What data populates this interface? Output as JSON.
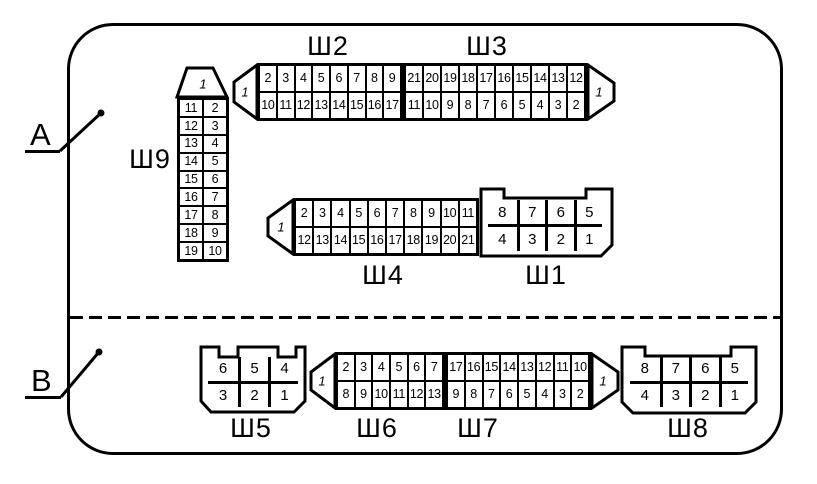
{
  "palette": {
    "ink": "#000000",
    "paper": "#ffffff"
  },
  "sections": {
    "a": {
      "label": "A"
    },
    "b": {
      "label": "B"
    }
  },
  "connectors": {
    "sh2": {
      "label": "Ш2",
      "end_pin": "1",
      "top": [
        "2",
        "3",
        "4",
        "5",
        "6",
        "7",
        "8",
        "9"
      ],
      "bottom": [
        "10",
        "11",
        "12",
        "13",
        "14",
        "15",
        "16",
        "17"
      ]
    },
    "sh3": {
      "label": "Ш3",
      "end_pin": "1",
      "top": [
        "21",
        "20",
        "19",
        "18",
        "17",
        "16",
        "15",
        "14",
        "13",
        "12"
      ],
      "bottom": [
        "11",
        "10",
        "9",
        "8",
        "7",
        "6",
        "5",
        "4",
        "3",
        "2"
      ]
    },
    "sh9": {
      "label": "Ш9",
      "end_pin": "1",
      "cells": [
        "11",
        "2",
        "12",
        "3",
        "13",
        "4",
        "14",
        "5",
        "15",
        "6",
        "16",
        "7",
        "17",
        "8",
        "18",
        "9",
        "19",
        "10"
      ]
    },
    "sh4": {
      "label": "Ш4",
      "end_pin": "1",
      "top": [
        "2",
        "3",
        "4",
        "5",
        "6",
        "7",
        "8",
        "9",
        "10",
        "11"
      ],
      "bottom": [
        "12",
        "13",
        "14",
        "15",
        "16",
        "17",
        "18",
        "19",
        "20",
        "21"
      ]
    },
    "sh1": {
      "label": "Ш1",
      "top": [
        "8",
        "7",
        "6",
        "5"
      ],
      "bottom": [
        "4",
        "3",
        "2",
        "1"
      ]
    },
    "sh5": {
      "label": "Ш5",
      "top": [
        "6",
        "5",
        "4"
      ],
      "bottom": [
        "3",
        "2",
        "1"
      ]
    },
    "sh6": {
      "label": "Ш6",
      "end_pin": "1",
      "top": [
        "2",
        "3",
        "4",
        "5",
        "6",
        "7"
      ],
      "bottom": [
        "8",
        "9",
        "10",
        "11",
        "12",
        "13"
      ]
    },
    "sh7": {
      "label": "Ш7",
      "end_pin": "1",
      "top": [
        "17",
        "16",
        "15",
        "14",
        "13",
        "12",
        "11",
        "10"
      ],
      "bottom": [
        "9",
        "8",
        "7",
        "6",
        "5",
        "4",
        "3",
        "2"
      ]
    },
    "sh8": {
      "label": "Ш8",
      "top": [
        "8",
        "7",
        "6",
        "5"
      ],
      "bottom": [
        "4",
        "3",
        "2",
        "1"
      ]
    }
  }
}
